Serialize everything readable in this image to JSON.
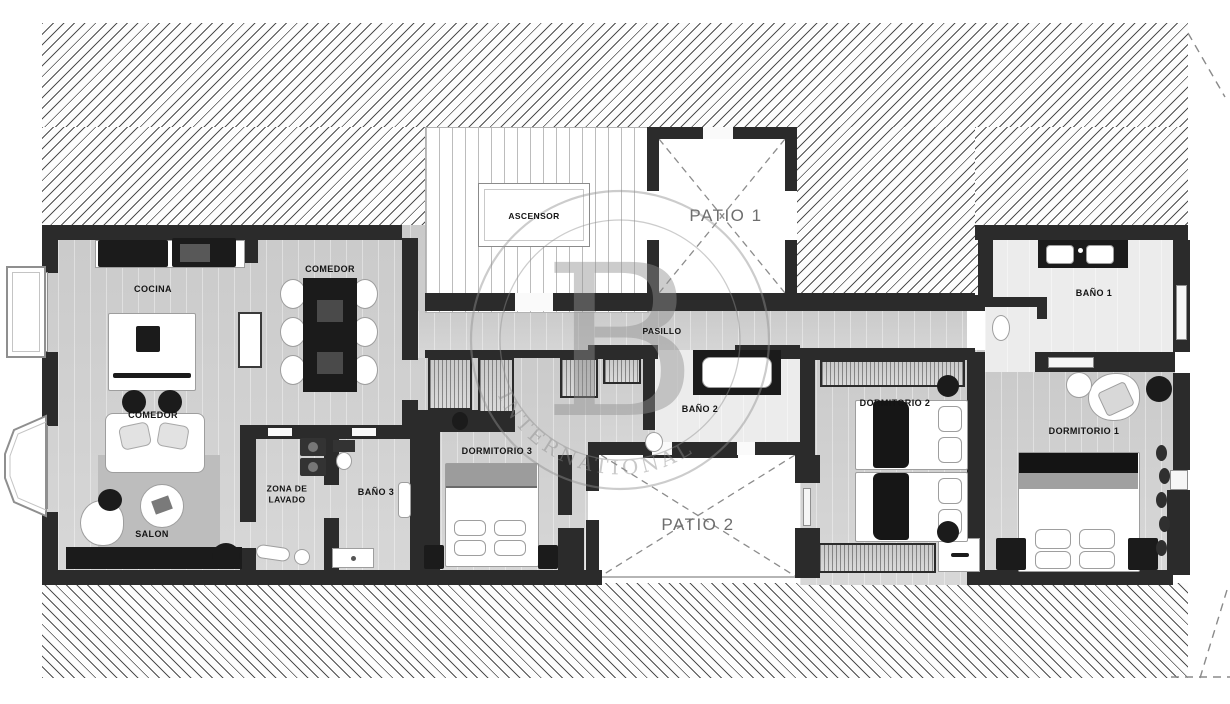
{
  "plan": {
    "rooms": {
      "cocina": "COCINA",
      "comedor_kitchen": "COMEDOR",
      "comedor": "COMEDOR",
      "salon": "SALON",
      "zona_de_lavado_line1": "ZONA DE",
      "zona_de_lavado_line2": "LAVADO",
      "bano3": "BAÑO 3",
      "dormitorio3": "DORMITORIO 3",
      "pasillo": "PASILLO",
      "bano2": "BAÑO 2",
      "ascensor": "ASCENSOR",
      "patio1": "PATIO 1",
      "patio2": "PATIO 2",
      "dormitorio2": "DORMITORIO 2",
      "dormitorio1": "DORMITORIO 1",
      "bano1": "BAÑO 1"
    },
    "watermark": {
      "letter": "B",
      "arc_text": "INTERNATIONAL"
    },
    "colors": {
      "wall": "#2b2b2b",
      "hatch_line": "#4f4f4f",
      "patio_label": "#6e6e6e",
      "watermark": "#909090"
    }
  }
}
